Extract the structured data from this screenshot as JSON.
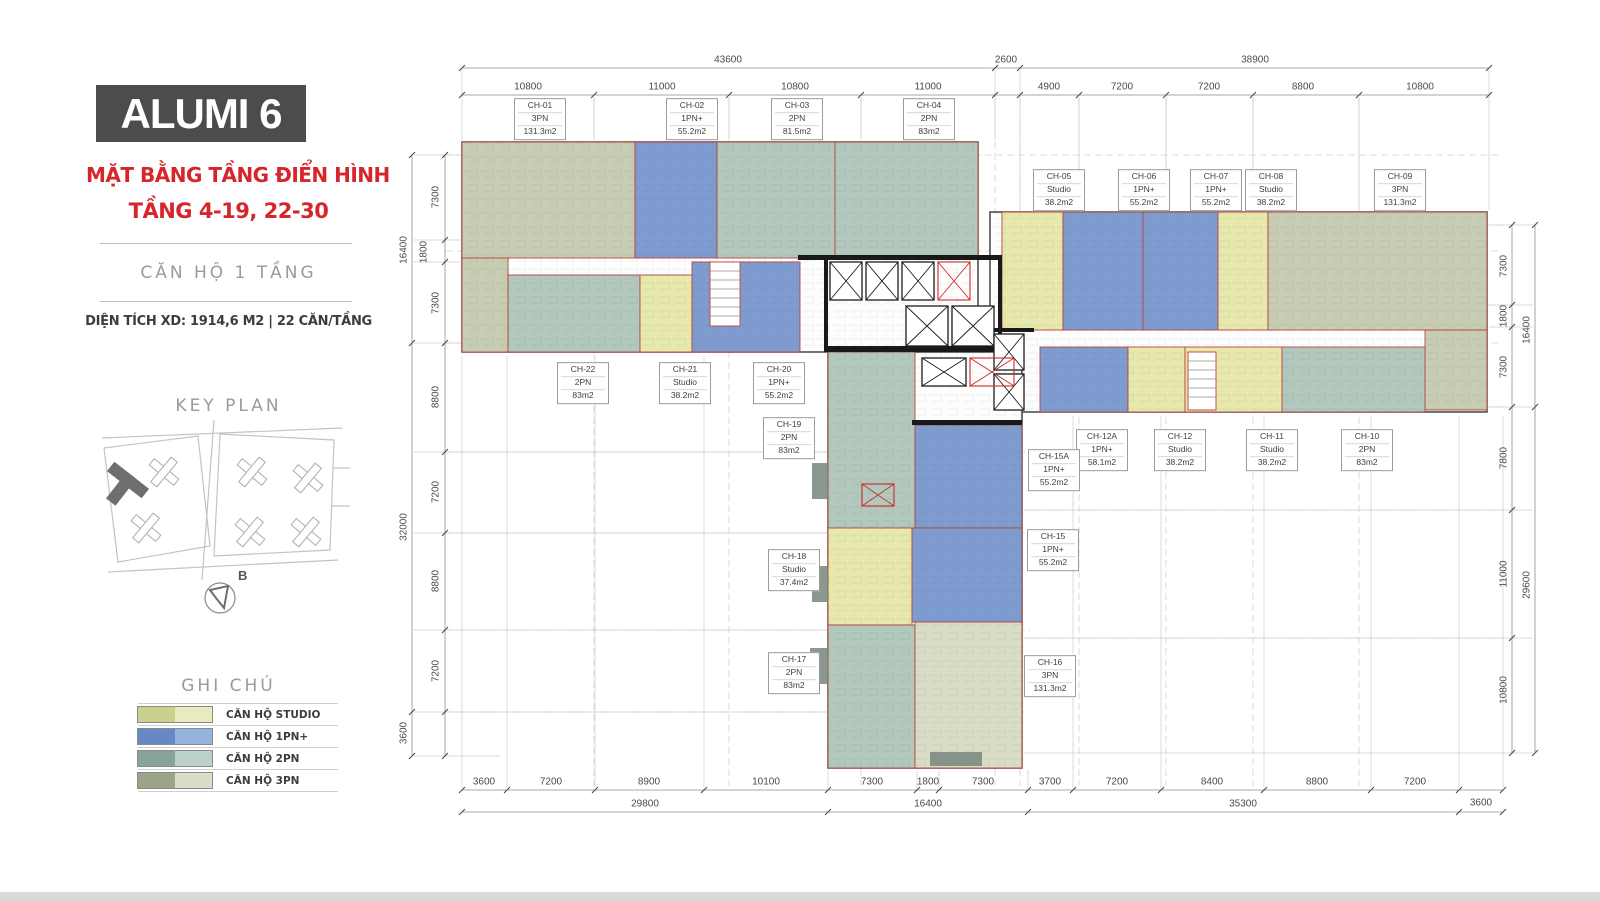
{
  "sidebar": {
    "title": "ALUMI 6",
    "subtitle1": "MẶT BẰNG TẦNG ĐIỂN HÌNH",
    "subtitle2": "TẦNG 4-19, 22-30",
    "unit_type_line": "CĂN HỘ 1 TẦNG",
    "area_line": "DIỆN TÍCH XD: 1914,6 M2  |  22 CĂN/TẦNG",
    "key_plan_title": "KEY PLAN",
    "compass_label": "B",
    "legend_title": "GHI CHÚ",
    "accent_red": "#d6262c",
    "title_bg": "#4c4c4e",
    "legend": [
      {
        "label": "CĂN HỘ STUDIO",
        "color_dark": "#ccd08d",
        "color_light": "#e9ebbd"
      },
      {
        "label": "CĂN HỘ 1PN+",
        "color_dark": "#6688c5",
        "color_light": "#94b3dd"
      },
      {
        "label": "CĂN HỘ 2PN",
        "color_dark": "#86a498",
        "color_light": "#bdd1c8"
      },
      {
        "label": "CĂN HỘ 3PN",
        "color_dark": "#9aa489",
        "color_light": "#dadec9"
      }
    ]
  },
  "plan": {
    "units": [
      {
        "id": "CH-01",
        "type": "3PN",
        "area": "131.3m2"
      },
      {
        "id": "CH-02",
        "type": "1PN+",
        "area": "55.2m2"
      },
      {
        "id": "CH-03",
        "type": "2PN",
        "area": "81.5m2"
      },
      {
        "id": "CH-04",
        "type": "2PN",
        "area": "83m2"
      },
      {
        "id": "CH-05",
        "type": "Studio",
        "area": "38.2m2"
      },
      {
        "id": "CH-06",
        "type": "1PN+",
        "area": "55.2m2"
      },
      {
        "id": "CH-07",
        "type": "1PN+",
        "area": "55.2m2"
      },
      {
        "id": "CH-08",
        "type": "Studio",
        "area": "38.2m2"
      },
      {
        "id": "CH-09",
        "type": "3PN",
        "area": "131.3m2"
      },
      {
        "id": "CH-10",
        "type": "2PN",
        "area": "83m2"
      },
      {
        "id": "CH-11",
        "type": "Studio",
        "area": "38.2m2"
      },
      {
        "id": "CH-12",
        "type": "Studio",
        "area": "38.2m2"
      },
      {
        "id": "CH-12A",
        "type": "1PN+",
        "area": "58.1m2"
      },
      {
        "id": "CH-15A",
        "type": "1PN+",
        "area": "55.2m2"
      },
      {
        "id": "CH-15",
        "type": "1PN+",
        "area": "55.2m2"
      },
      {
        "id": "CH-16",
        "type": "3PN",
        "area": "131.3m2"
      },
      {
        "id": "CH-17",
        "type": "2PN",
        "area": "83m2"
      },
      {
        "id": "CH-18",
        "type": "Studio",
        "area": "37.4m2"
      },
      {
        "id": "CH-19",
        "type": "2PN",
        "area": "83m2"
      },
      {
        "id": "CH-20",
        "type": "1PN+",
        "area": "55.2m2"
      },
      {
        "id": "CH-21",
        "type": "Studio",
        "area": "38.2m2"
      },
      {
        "id": "CH-22",
        "type": "2PN",
        "area": "83m2"
      }
    ],
    "dims": {
      "top_totals": [
        "43600",
        "2600",
        "38900"
      ],
      "top_segments_left": [
        "10800",
        "11000",
        "10800",
        "11000"
      ],
      "top_segments_right": [
        "4900",
        "7200",
        "7200",
        "8800",
        "10800"
      ],
      "bottom_segments_left": [
        "3600",
        "7200",
        "8900",
        "10100",
        "7300",
        "1800",
        "7300"
      ],
      "bottom_segments_right": [
        "3700",
        "7200",
        "8400",
        "8800",
        "7200",
        "3600"
      ],
      "bottom_totals": [
        "29800",
        "16400",
        "35300"
      ],
      "left_segments": [
        "7300",
        "1800",
        "7300",
        "8800",
        "7200",
        "8800",
        "7200"
      ],
      "left_totals": [
        "16400",
        "32000",
        "3600"
      ],
      "right_segments": [
        "7300",
        "1800",
        "7300",
        "7800",
        "11000",
        "10800"
      ],
      "right_totals": [
        "16400",
        "29600"
      ]
    }
  }
}
